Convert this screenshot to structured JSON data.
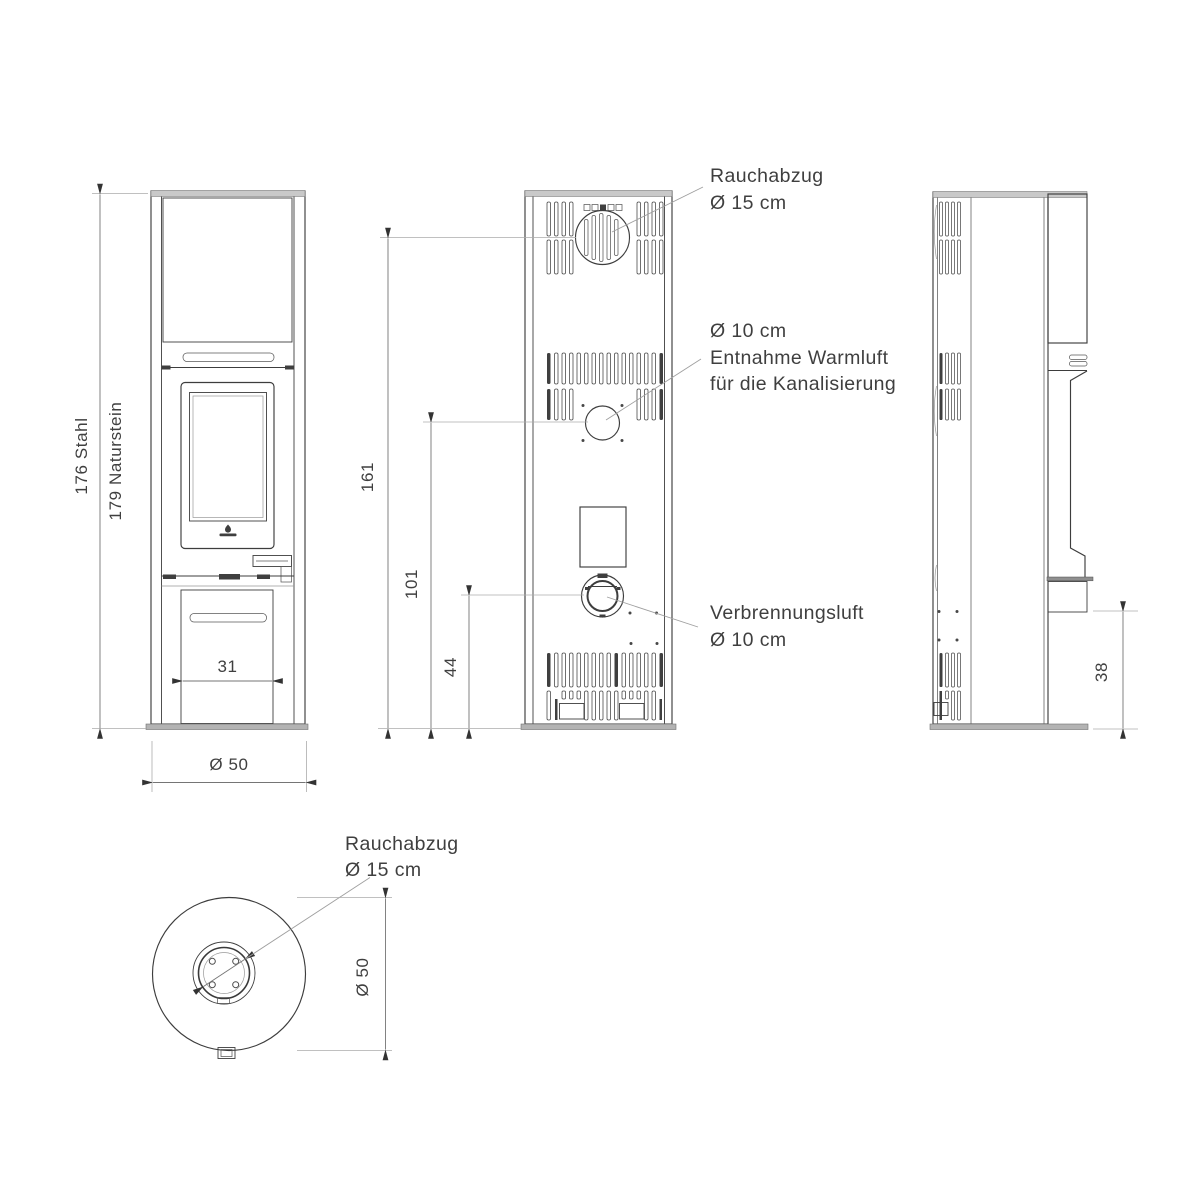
{
  "colors": {
    "line": "#3d3d3d",
    "dimension_line": "#757575",
    "extension_line": "#ababab",
    "leader_line": "#9f9f9f",
    "text": "#3f3f3f",
    "top_band": "#c9c9c9",
    "base_plate": "#b3b3b3",
    "background": "#ffffff"
  },
  "dimensions": {
    "height_steel": "176 Stahl",
    "height_stone": "179 Naturstein",
    "flue_center_height": "161",
    "warm_air_center_height": "101",
    "combustion_air_center_height": "44",
    "base_opening_width": "31",
    "front_diameter": "Ø 50",
    "door_ledge_height": "38",
    "top_diameter": "Ø 50"
  },
  "labels": {
    "flue_rear": {
      "line1": "Rauchabzug",
      "line2": "Ø 15 cm"
    },
    "warm_air": {
      "line1": "Ø 10 cm",
      "line2": "Entnahme Warmluft",
      "line3": "für die Kanalisierung"
    },
    "combustion_air": {
      "line1": "Verbrennungsluft",
      "line2": "Ø 10 cm"
    },
    "flue_top": {
      "line1": "Rauchabzug",
      "line2": "Ø 15 cm"
    }
  },
  "icons": {
    "brand_logo": "brand-logo-icon",
    "flue_outlet": "flue-outlet-circle",
    "warm_air_outlet": "warm-air-outlet-circle",
    "combustion_air_inlet": "combustion-air-inlet-circle"
  }
}
